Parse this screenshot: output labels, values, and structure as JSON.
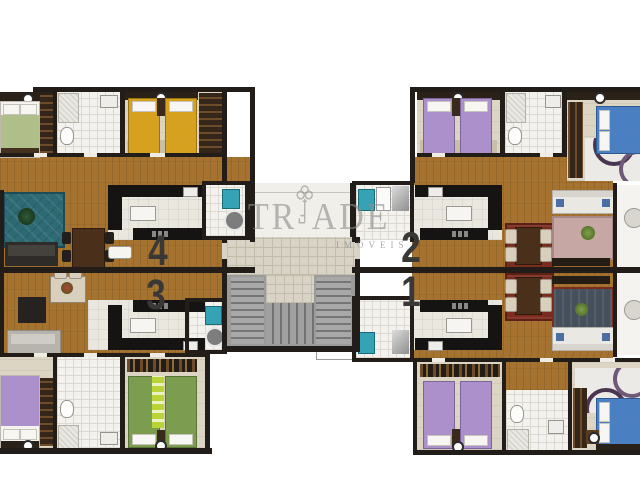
{
  "watermark": {
    "brand": "TRIADE",
    "subtitle": "IMÓVEIS",
    "icon": "key-icon"
  },
  "units": [
    {
      "label": "4"
    },
    {
      "label": "3"
    },
    {
      "label": "2"
    },
    {
      "label": "1"
    }
  ],
  "decor": {
    "rug_flower": "✻"
  },
  "palette": {
    "wall": "#221d18",
    "wood": "#a5732f",
    "room": "#ddd5c4",
    "bath": "#f3f2ee",
    "bath-line": "#dcd9d0",
    "kitchen": "#eae7df",
    "counter": "#151413",
    "tile": "#d8d3c5",
    "tile-line": "#c2bcab",
    "hall": "#f1efe9",
    "stair": "#9b9b9b",
    "washer": "#35a3b5",
    "teal": "#2d6a74",
    "sofa-dark": "#2e2b28",
    "sofa-gray": "#b7b4ae",
    "sofa-white": "#eae8e3",
    "bed-yellow": "#d6a11f",
    "bed-purple": "#ab90cb",
    "bed-green": "#7c9c50",
    "bed-blue": "#4a7fc1",
    "lime": "#b9d437",
    "rug-red": "#7c2c1e",
    "rug-pink": "#c7a7a3",
    "rug-navy": "#45505c",
    "wardrobe": "#35261a",
    "shelf": "#241d15",
    "table-brown": "#4a2f1a",
    "cream": "#d9cfbd",
    "watermark": "#8f8f8f",
    "label": "#3a3836"
  }
}
